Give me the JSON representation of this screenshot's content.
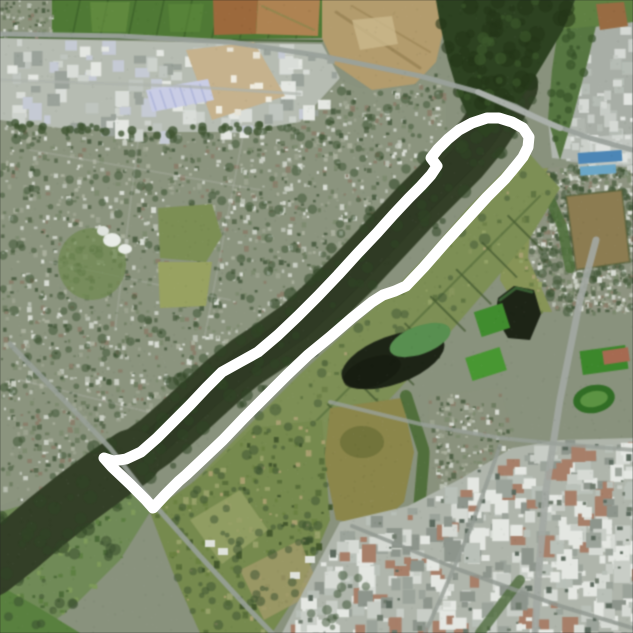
{
  "map": {
    "view": "satellite-aerial",
    "scene": "Aerial satellite view of a dark river running diagonally (NE to SW) through a town: suburbs on the north-west bank, farmland and ponds on the south-east bank, industrial estates top-left and bottom-right, a bridge at the top, with a white GPS activity route drawn as a long narrow loop along the river.",
    "route_overlay": {
      "description": "White GPS track: out-and-back rowing-style loop along the river with a rounded turnaround hook at the south-west end and a wider loop at the north-east end",
      "color": "#ffffff",
      "stroke_width": 11,
      "closed": true,
      "points": [
        [
          104,
          458
        ],
        [
          112,
          467
        ],
        [
          130,
          484
        ],
        [
          146,
          500
        ],
        [
          153,
          508
        ],
        [
          166,
          494
        ],
        [
          179,
          481
        ],
        [
          186,
          475
        ],
        [
          203,
          459
        ],
        [
          223,
          440
        ],
        [
          244,
          418
        ],
        [
          266,
          396
        ],
        [
          287,
          375
        ],
        [
          308,
          355
        ],
        [
          330,
          337
        ],
        [
          352,
          318
        ],
        [
          372,
          302
        ],
        [
          383,
          295
        ],
        [
          395,
          291
        ],
        [
          406,
          286
        ],
        [
          424,
          267
        ],
        [
          445,
          243
        ],
        [
          466,
          220
        ],
        [
          487,
          197
        ],
        [
          505,
          179
        ],
        [
          515,
          167
        ],
        [
          523,
          157
        ],
        [
          528,
          147
        ],
        [
          529,
          137
        ],
        [
          523,
          128
        ],
        [
          512,
          122
        ],
        [
          499,
          118
        ],
        [
          487,
          118
        ],
        [
          472,
          123
        ],
        [
          459,
          130
        ],
        [
          448,
          139
        ],
        [
          438,
          149
        ],
        [
          431,
          158
        ],
        [
          437,
          166
        ],
        [
          431,
          175
        ],
        [
          421,
          186
        ],
        [
          409,
          198
        ],
        [
          394,
          214
        ],
        [
          377,
          233
        ],
        [
          358,
          253
        ],
        [
          338,
          275
        ],
        [
          318,
          296
        ],
        [
          298,
          316
        ],
        [
          278,
          335
        ],
        [
          258,
          352
        ],
        [
          240,
          362
        ],
        [
          222,
          372
        ],
        [
          206,
          388
        ],
        [
          190,
          405
        ],
        [
          173,
          422
        ],
        [
          157,
          438
        ],
        [
          141,
          452
        ],
        [
          126,
          459
        ],
        [
          113,
          461
        ]
      ]
    },
    "palette": {
      "base": "#89927c",
      "river": "#333f26",
      "river_deep": "#2b351f",
      "forest": "#2c4220",
      "residential_base": "#8b947d",
      "pasture": "#7d8f53",
      "field_green": "#4e7a33",
      "field_brown": "#9e693a",
      "field_tan": "#b08350",
      "quarry_tan": "#b49c6b",
      "industrial_base": "#b6bcb2",
      "industrial_roof": "#e4e7e2",
      "warehouse_lavender": "#c9cde6",
      "pond_dark": "#1d2416",
      "pond_green": "#56904e",
      "pool_blue": "#4a86b8",
      "sports_green": "#3e8d2b",
      "oval_green": "#2f6e23",
      "red_roof": "#a86a50",
      "road": "#9aa19b",
      "tree": "#3a5130",
      "track_white": "#ffffff"
    }
  }
}
